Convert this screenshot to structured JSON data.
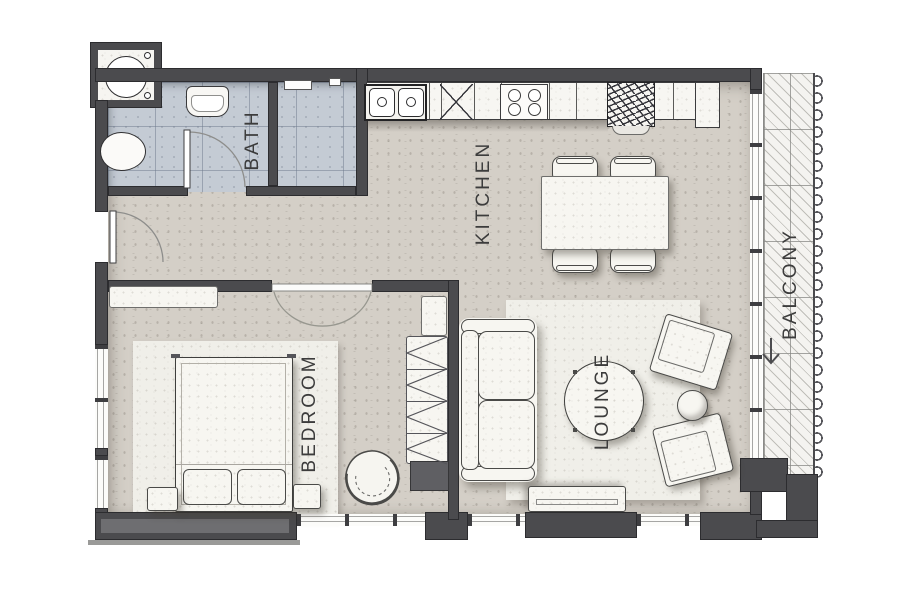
{
  "floorplan": {
    "rooms": [
      {
        "name": "bath",
        "label": "BATH"
      },
      {
        "name": "kitchen",
        "label": "KITCHEN"
      },
      {
        "name": "balcony",
        "label": "BALCONY"
      },
      {
        "name": "bedroom",
        "label": "BEDROOM"
      },
      {
        "name": "lounge",
        "label": "LOUNGE"
      }
    ],
    "icons": [
      {
        "name": "balcony-direction-arrow-icon",
        "glyph": "down-arrow"
      }
    ],
    "colors": {
      "floor_main": "#d4cfc7",
      "floor_bath": "#c4cbd4",
      "rug": "#f0efe9",
      "wall": "#4b4b4e",
      "furniture": "#f7f6f1",
      "line": "#3d3d3d",
      "label": "#3c3c3c"
    }
  }
}
